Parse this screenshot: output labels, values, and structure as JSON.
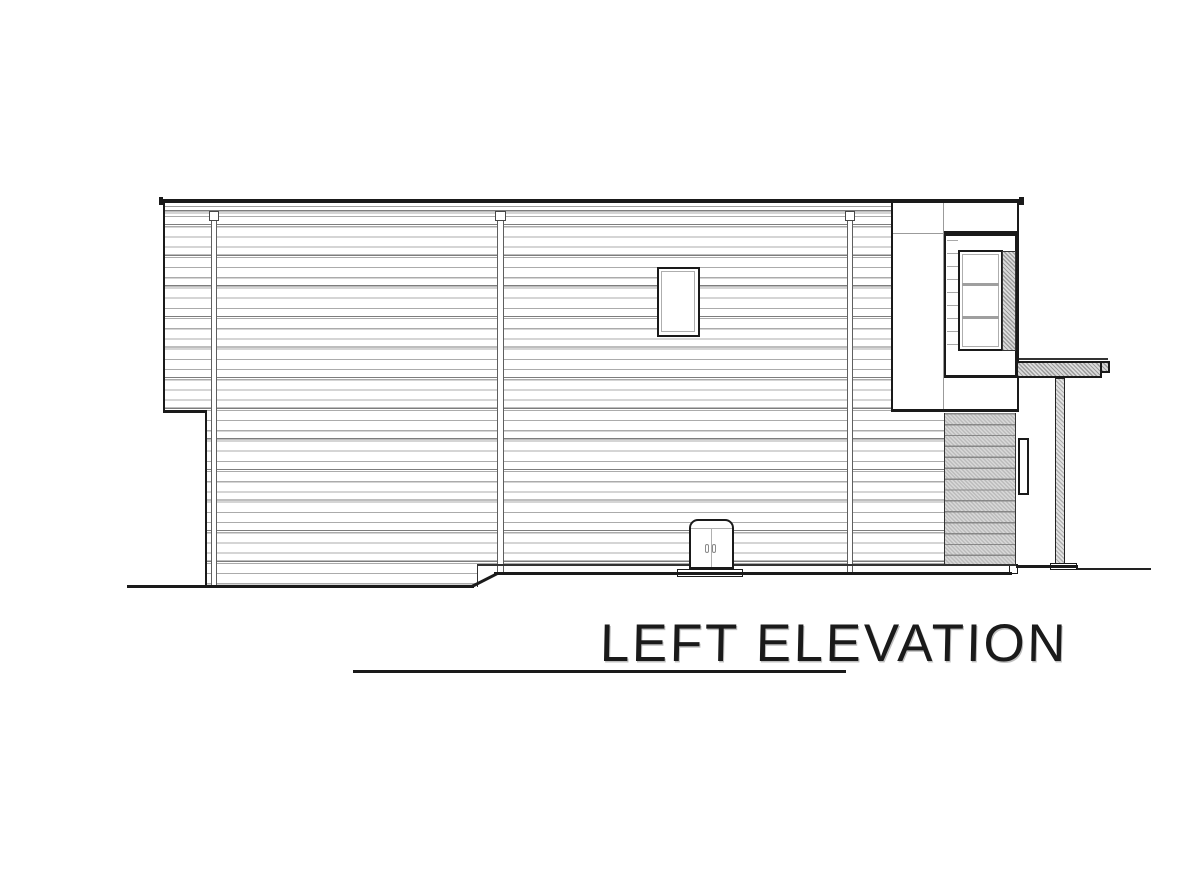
{
  "title": {
    "label": "LEFT ELEVATION",
    "underlined": true
  },
  "colors": {
    "background": "#ffffff",
    "ink": "#1a1a1a",
    "siding_line": "#ababab",
    "siding_line_dark": "#7d7d7d",
    "line_gray": "#9b9b9b",
    "hatch_gray": "#bcbcbc"
  },
  "drawing": {
    "kind": "architectural side elevation line drawing",
    "features": [
      "horizontal lap-siding wall",
      "flat roof fascia line",
      "three downspouts with top brackets",
      "small upper-storey window",
      "right bump-out with tall three-pane window",
      "diagonal-hatch jamb panel",
      "diagonal-hatch accent siding panel",
      "porch canopy slab with square post",
      "wall sconce light",
      "double-door utility cabinet on pad",
      "stepped grade line"
    ]
  }
}
